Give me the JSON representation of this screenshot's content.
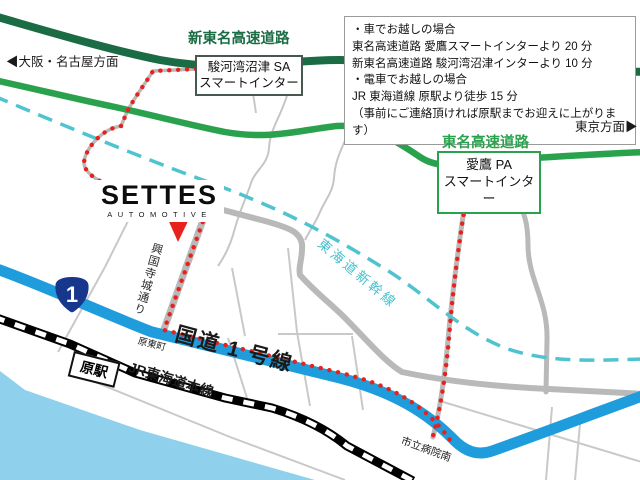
{
  "logo": {
    "title": "SETTES",
    "subtitle": "AUTOMOTIVE"
  },
  "info_box": {
    "lines": [
      "・車でお越しの場合",
      "東名高速道路 愛鷹スマートインターより 20 分",
      "新東名高速道路 駿河湾沼津インターより 10 分",
      "・電車でお越しの場合",
      "JR 東海道線 原駅より徒歩 15 分",
      "（事前にご連絡頂ければ原駅までお迎えに上がります）"
    ]
  },
  "highways": {
    "shin_tomei_label": "新東名高速道路",
    "tomei_label": "東名高速道路"
  },
  "interchanges": {
    "sa": {
      "line1": "駿河湾沼津 SA",
      "line2": "スマートインター"
    },
    "pa": {
      "line1": "愛鷹 PA",
      "line2": "スマートインター"
    }
  },
  "directions": {
    "west": "◀大阪・名古屋方面",
    "east": "東京方面▶"
  },
  "roads": {
    "route1_label": "国道 1 号線",
    "route1_shield": "1",
    "koukokuji_street": "興国寺城通り"
  },
  "rail": {
    "jr_line": "JR東海道本線",
    "station": "原駅",
    "shinkansen": "東海道新幹線"
  },
  "poi": {
    "harahigashi": "原東町",
    "city_hospital_south": "市立病院南"
  },
  "colors": {
    "shin_tomei_road": "#1b6b44",
    "tomei_road": "#2aa24d",
    "route1_road": "#1f9cdb",
    "shinkansen_line": "#4fc3cf",
    "route_dots": "#e8211d",
    "water": "#8fd0ed",
    "minor_road": "#c9c9c9",
    "shield_blue": "#17378c"
  }
}
